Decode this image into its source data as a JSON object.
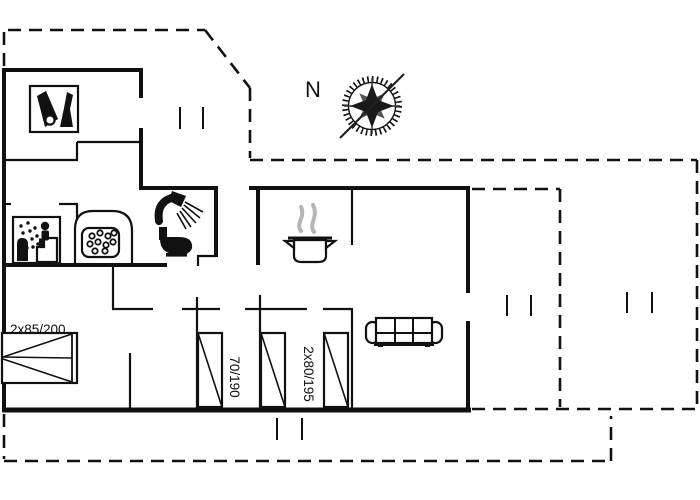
{
  "floorplan": {
    "compass": {
      "label": "N"
    },
    "bed_labels": {
      "double_bed": "2x85/200",
      "single_bed": "70/190",
      "twin_beds": "2x80/195"
    },
    "fixtures": [
      "cleaning-equipment",
      "sauna",
      "whirlpool-tub",
      "shower",
      "toilet",
      "cooking-pot",
      "sofa",
      "double-bed",
      "single-bed-70x190",
      "single-bed-80x195",
      "single-bed-80x195",
      "compass-rose"
    ],
    "colors": {
      "wall": "#111111",
      "steam": "#b5b5b5",
      "background": "#ffffff",
      "compass_text": "#222222"
    }
  }
}
